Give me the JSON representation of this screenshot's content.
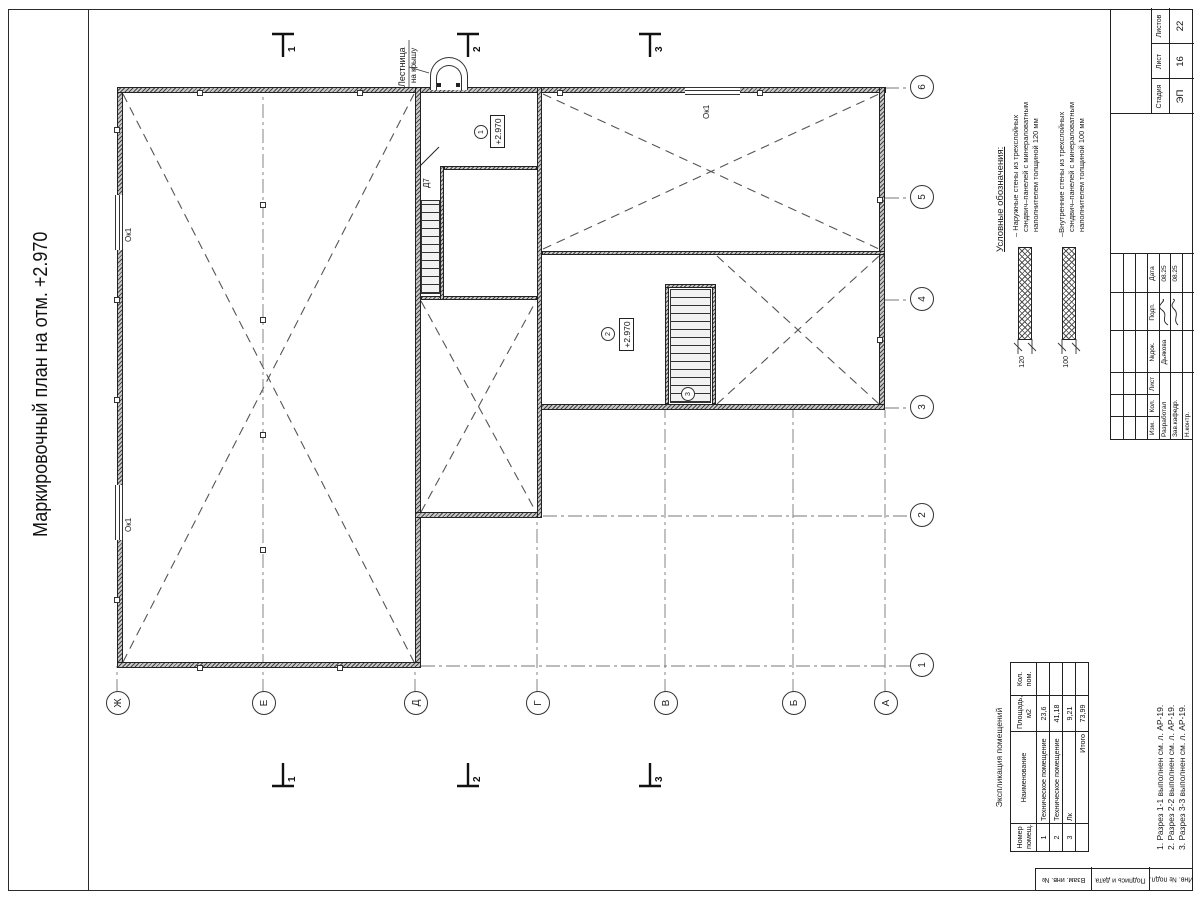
{
  "title": "Маркировочный план на отм. +2.970",
  "plan": {
    "grid": {
      "letters": [
        "Ж",
        "Е",
        "Д",
        "Г",
        "В",
        "Б",
        "А"
      ],
      "numbers": [
        "1",
        "2",
        "3",
        "4",
        "5",
        "6"
      ]
    },
    "sections": [
      "1",
      "2",
      "3"
    ],
    "window_label": "Ок1",
    "door_label": "Д7",
    "roof_ladder": {
      "line1": "Лестница",
      "line2": "на крышу"
    },
    "rooms": [
      {
        "num": "1",
        "elevation": "+2.970"
      },
      {
        "num": "2",
        "elevation": "+2.970"
      },
      {
        "num": "3",
        "elevation": ""
      }
    ]
  },
  "legend": {
    "title": "Условные обозначения:",
    "items": [
      {
        "dim": "120",
        "lines": [
          "– Наружные стены из трехслойных",
          "сэндвич–панелей с минераловатным",
          "наполнителем толщиной 120 мм"
        ]
      },
      {
        "dim": "100",
        "lines": [
          "–Внутренние стены из трехслойных",
          "сэндвич–панелей с минераловатным",
          "наполнителем толщиной 100 мм"
        ]
      }
    ]
  },
  "explication": {
    "title": "Экспликация помещений",
    "headers": [
      "Номер помещ.",
      "Наименование",
      "Площадь, м2",
      "Кол. пом."
    ],
    "rows": [
      [
        "1",
        "Техническое помещение",
        "23,6",
        ""
      ],
      [
        "2",
        "Техническое помещение",
        "41,18",
        ""
      ],
      [
        "3",
        "Лк",
        "9,21",
        ""
      ],
      [
        "",
        "Итого",
        "73,99",
        ""
      ]
    ]
  },
  "notes": [
    "1. Разрез 1-1 выполнен см. л. АР-19.",
    "2. Разрез 2-2 выполнен см. л. АР-19.",
    "3. Разрез 3-3 выполнен см. л. АР-19."
  ],
  "stamp": {
    "change_header": [
      "Изм.",
      "Кол.",
      "Лист",
      "№док.",
      "Подп.",
      "Дата"
    ],
    "rows": [
      {
        "role": "Разработал",
        "name": "Дьякова",
        "date": "08.25"
      },
      {
        "role": "Зав.кафедр.",
        "name": "",
        "date": "08.25"
      },
      {
        "role": "Н.контр.",
        "name": "",
        "date": ""
      }
    ],
    "stage_header": [
      "Стадия",
      "Лист",
      "Листов"
    ],
    "stage_values": [
      "ЭП",
      "16",
      "22"
    ]
  },
  "margin_labels": [
    "Взам. инв. №",
    "Подпись и дата",
    "Инв. № подл."
  ]
}
